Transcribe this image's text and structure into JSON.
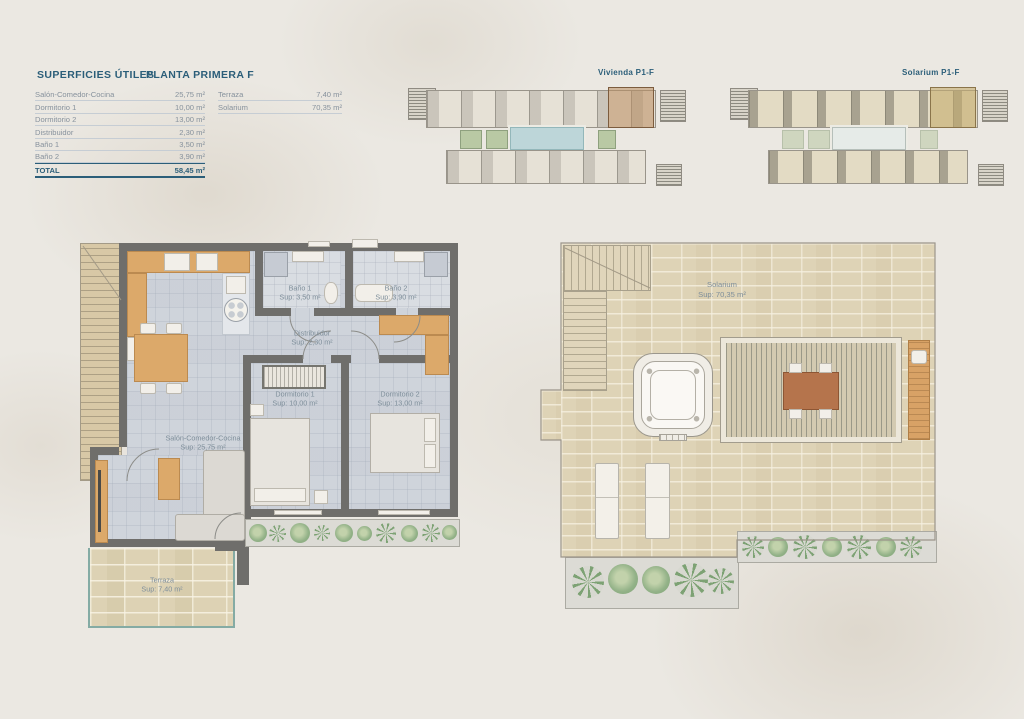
{
  "header": {
    "title": "SUPERFICIES ÚTILES",
    "subtitle": "PLANTA PRIMERA F"
  },
  "surfaces_table": {
    "rows": [
      {
        "label": "Salón-Comedor-Cocina",
        "value": "25,75 m²"
      },
      {
        "label": "Dormitorio 1",
        "value": "10,00 m²"
      },
      {
        "label": "Dormitorio 2",
        "value": "13,00 m²"
      },
      {
        "label": "Distribuidor",
        "value": "2,30 m²"
      },
      {
        "label": "Baño 1",
        "value": "3,50 m²"
      },
      {
        "label": "Baño 2",
        "value": "3,90 m²"
      }
    ],
    "total_label": "TOTAL",
    "total_value": "58,45 m²"
  },
  "exterior_table": {
    "rows": [
      {
        "label": "Terraza",
        "value": "7,40 m²"
      },
      {
        "label": "Solarium",
        "value": "70,35 m²"
      }
    ]
  },
  "minimaps": {
    "vivienda_title": "Vivienda P1-F",
    "solarium_title": "Solarium P1-F"
  },
  "apartment_plan": {
    "rooms": [
      {
        "name": "Baño 1",
        "sup": "Sup: 3,50 m²"
      },
      {
        "name": "Baño 2",
        "sup": "Sup: 3,90 m²"
      },
      {
        "name": "Distribuidor",
        "sup": "Sup: 2,30 m²"
      },
      {
        "name": "Dormitorio 1",
        "sup": "Sup: 10,00 m²"
      },
      {
        "name": "Dormitorio 2",
        "sup": "Sup: 13,00 m²"
      },
      {
        "name": "Salón-Comedor-Cocina",
        "sup": "Sup: 25,75 m²"
      },
      {
        "name": "Terraza",
        "sup": "Sup: 7,40 m²"
      }
    ]
  },
  "solarium_plan": {
    "room": {
      "name": "Solarium",
      "sup": "Sup: 70,35 m²"
    }
  },
  "colors": {
    "accent_teal": "#2b5e79",
    "label_gray": "#7e8e9a",
    "wall_gray": "#6f6e6b",
    "wood": "#dca96a",
    "floor_tile": "#cfd4db",
    "stone_tile": "#ddd2b4",
    "plant_green": "#8fae85",
    "pool_blue": "#bdd6d9",
    "background": "#ebe8e2"
  }
}
